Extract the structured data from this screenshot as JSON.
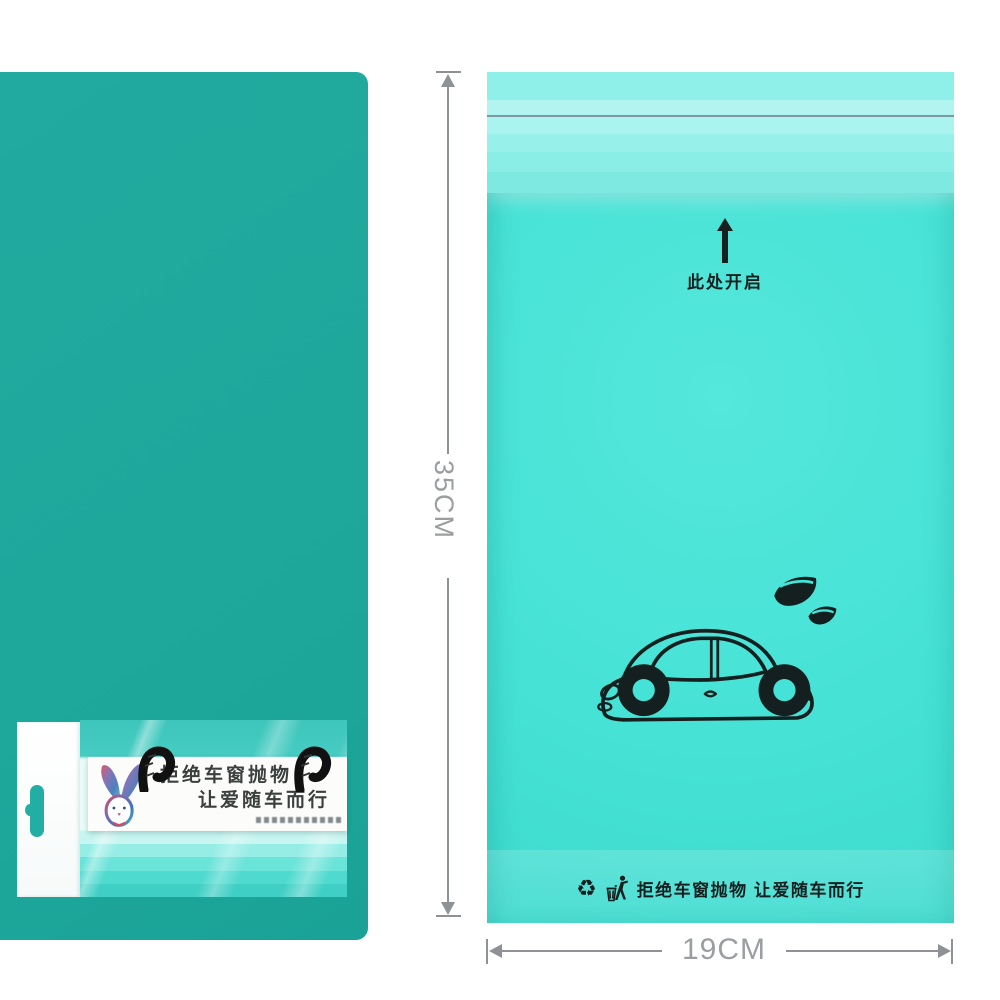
{
  "left_package": {
    "panel_color": "#1EA89C",
    "label": {
      "line1": "拒绝车窗抛物",
      "line2": "让爱随车而行"
    }
  },
  "bag": {
    "main_color": "#45E2D7",
    "flap_color": "#9FF2EB",
    "ink_color": "#14201F",
    "open_hint": "此处开启",
    "footer_text": "拒绝车窗抛物 让爱随车而行",
    "recycle_glyph": "♻"
  },
  "dimensions": {
    "height_label": "35CM",
    "width_label": "19CM",
    "line_color": "#8E9296"
  },
  "icons": {
    "arrow_up": "arrow-up-icon",
    "recycle": "recycle-icon",
    "tidyman": "tidyman-litter-icon",
    "car": "eco-car-illustration",
    "leaves": "leaf-illustration",
    "rabbit": "rabbit-illustration",
    "hooks": "rope-hook-icon",
    "hang_hole": "euro-slot-hang-hole"
  }
}
